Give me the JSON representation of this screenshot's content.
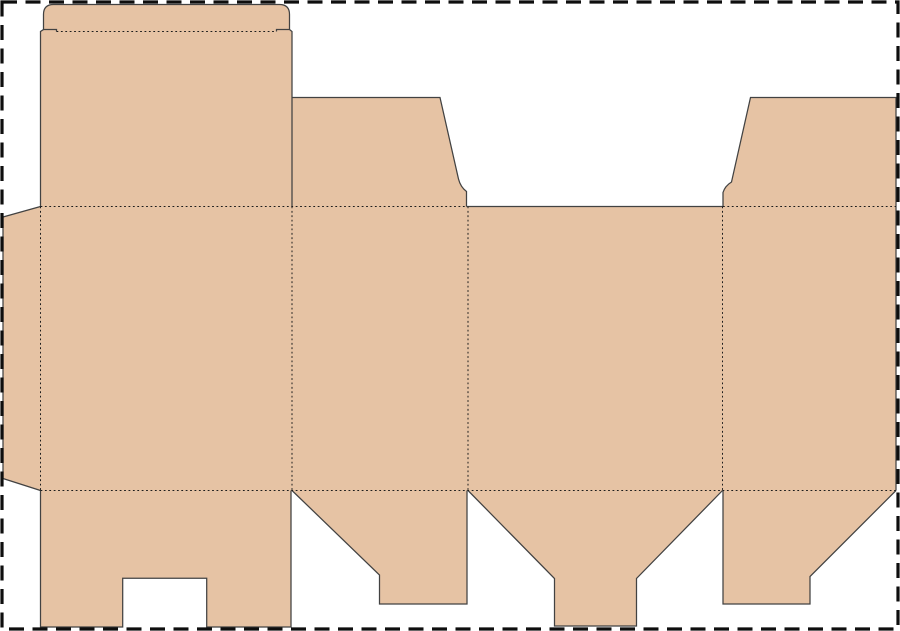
{
  "document": {
    "type": "box-dieline-template",
    "description": "Unfolded folding-carton (tuck top box) die-cut layout",
    "background_color": "#ffffff"
  },
  "canvas": {
    "width": 900,
    "height": 631
  },
  "selection_border": {
    "color": "#0e0e0e",
    "stroke_width": 3.2,
    "dash": "15 8.5",
    "inset": 2
  },
  "dieline": {
    "fill_color": "#e6c3a4",
    "cut_line_color": "#424242",
    "cut_line_width": 1.25,
    "fold_line_color": "#1c1c1c",
    "fold_line_width": 1,
    "fold_dash": "1.8 2.6",
    "panels": [
      {
        "name": "glue-tab",
        "role": "glue tab",
        "path": "M3,217 L40.5,206.5 L40.5,490.5 L3,478.5 Z"
      },
      {
        "name": "lid-and-tuck-flap",
        "role": "lid panel with rounded tuck flap",
        "path": "M40.5,206.5 L40.5,31.5 L43.5,29.5 L43.5,14.5 Q43.5,4.5 53.5,4.5 L279.5,4.5 Q289.5,4.5 289.5,14.5 L289.5,29.5 L292,31.5 L292,206.5 Z"
      },
      {
        "name": "main-panel-row",
        "role": "four body panels",
        "path": "M40.5,206.5 L896,206.5 L896,490.5 L40.5,490.5 Z"
      },
      {
        "name": "top-dust-flap-left",
        "role": "top dust flap on panel 2",
        "path": "M292,206.5 L292,97.5 L440,97.5 L458.5,179 Q460.5,187 466.5,191.5 L466.5,206.5 Z"
      },
      {
        "name": "top-dust-flap-right",
        "role": "top dust flap on panel 4",
        "path": "M723,206.5 L723,192.5 Q725,186 731.5,182 L750.5,97.5 L896,97.5 L896,206.5 Z"
      },
      {
        "name": "bottom-flap-notched",
        "role": "bottom flap of panel 1 with lock notch",
        "path": "M40.5,490.5 L291,490.5 L291,627 L206.7,627 L206.7,578.3 L122.7,578.3 L122.7,627 L40.5,627 Z"
      },
      {
        "name": "bottom-flap-panel2",
        "role": "bottom flap of panel 2",
        "path": "M292,490.5 L467,490.5 L467,604 L379.5,604 L379.5,575 Z"
      },
      {
        "name": "bottom-tuck-flap",
        "role": "bottom tuck flap of panel 3",
        "path": "M468,490.5 L554.5,578.5 L554.5,626 L636.5,626 L636.5,578.5 L722.5,490.5 Z"
      },
      {
        "name": "bottom-flap-panel4",
        "role": "bottom flap of panel 4",
        "path": "M723,490.5 L896,490.5 L810,576.5 L810,604 L723,604 Z"
      }
    ],
    "cut_lines": [
      {
        "name": "cut-glue-tab",
        "path": "M40.5,206.5 L3,217 L3,478.5 L40.5,490.5"
      },
      {
        "name": "cut-lid-tuck-flap",
        "path": "M40.5,206.5 L40.5,31.5 L43.5,29.5 L43.5,14.5 Q43.5,4.5 53.5,4.5 L279.5,4.5 Q289.5,4.5 289.5,14.5 L289.5,29.5 L292,31.5 L292,206.5"
      },
      {
        "name": "cut-tuck-shoulder-left",
        "path": "M43.5,29.5 L56.5,29.5 L56.5,31.5"
      },
      {
        "name": "cut-tuck-shoulder-right",
        "path": "M289.5,29.5 L276.5,29.5 L276.5,31.5"
      },
      {
        "name": "cut-top-dust-flap-left",
        "path": "M292,97.5 L440,97.5 L458.5,179 Q460.5,187 466.5,191.5 L466.5,206.5"
      },
      {
        "name": "cut-panel3-top-edge",
        "path": "M466.5,206.5 L723,206.5"
      },
      {
        "name": "cut-top-dust-flap-right",
        "path": "M723,206.5 L723,192.5 Q725,186 731.5,182 L750.5,97.5 L896,97.5 L896,490.5"
      },
      {
        "name": "cut-bottom-flap-notched",
        "path": "M40.5,490.5 L40.5,627 L122.7,627 L122.7,578.3 L206.7,578.3 L206.7,627 L291,627 L291,490.5"
      },
      {
        "name": "cut-bottom-flap-panel2",
        "path": "M292,490.5 L379.5,575 L379.5,604 L467,604 L467,490.5"
      },
      {
        "name": "cut-bottom-tuck-flap",
        "path": "M468,490.5 L554.5,578.5 L554.5,626 L636.5,626 L636.5,578.5 L722.5,490.5"
      },
      {
        "name": "cut-bottom-flap-panel4",
        "path": "M723,490.5 L723,604 L810,604 L810,576.5 L896,490.5"
      }
    ],
    "fold_lines": [
      {
        "name": "fold-glue-tab",
        "path": "M40.5,206.5 L40.5,490.5"
      },
      {
        "name": "fold-panel-1-2",
        "path": "M292,206.5 L292,490.5"
      },
      {
        "name": "fold-panel-2-3",
        "path": "M468,206.5 L468,490.5"
      },
      {
        "name": "fold-panel-3-4",
        "path": "M722.5,206.5 L722.5,490.5"
      },
      {
        "name": "fold-top-row-left",
        "path": "M40.5,206.5 L466.5,206.5"
      },
      {
        "name": "fold-top-row-right",
        "path": "M723,206.5 L896,206.5"
      },
      {
        "name": "fold-bottom-row",
        "path": "M40.5,490.5 L896,490.5"
      },
      {
        "name": "fold-tuck-flap",
        "path": "M56.5,31.5 L276.5,31.5"
      }
    ]
  }
}
